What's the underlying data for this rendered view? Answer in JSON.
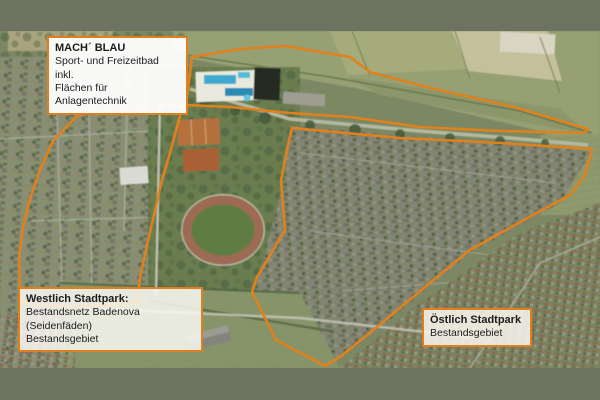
{
  "page": {
    "frame_color": "#6e7261",
    "outline_color": "#e0811c"
  },
  "map": {
    "labels": {
      "machblau": {
        "title": "MACH´ BLAU",
        "line1": "Sport- und Freizeitbad inkl.",
        "line2": "Flächen für Anlagentechnik"
      },
      "westlich": {
        "title": "Westlich Stadtpark:",
        "line1": "Bestandsnetz Badenova (Seidenfäden)",
        "line2": "Bestandsgebiet"
      },
      "oestlich": {
        "title": "Östlich Stadtpark",
        "line1": "Bestandsgebiet"
      }
    }
  }
}
